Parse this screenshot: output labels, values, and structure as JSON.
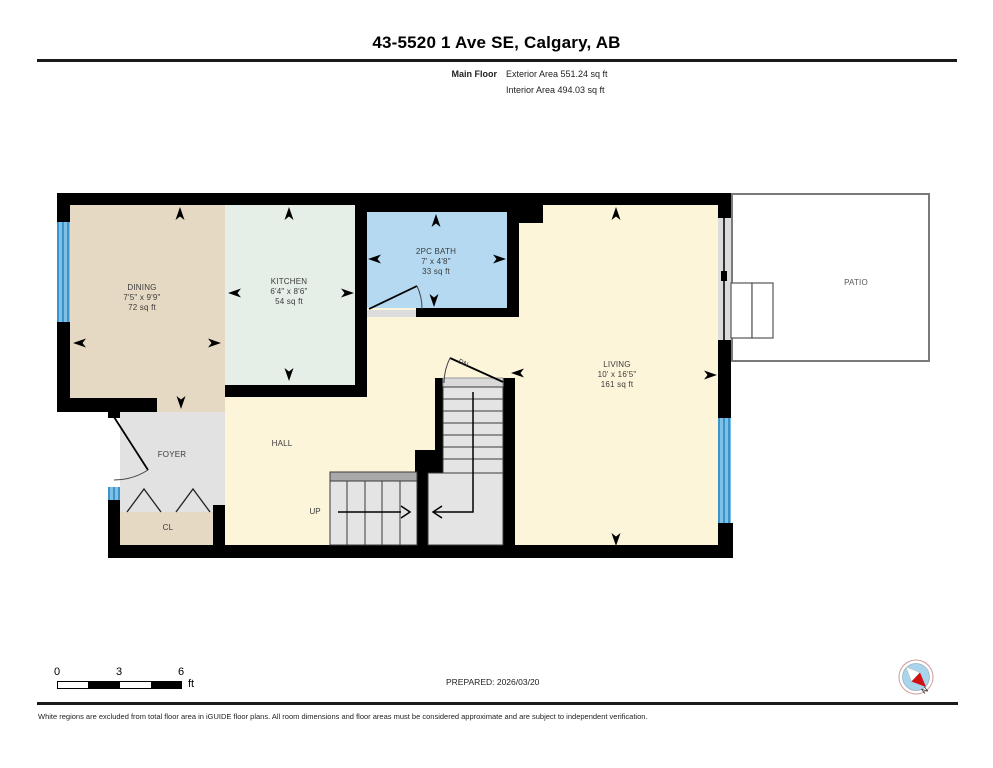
{
  "header": {
    "title": "43-5520 1 Ave SE, Calgary, AB",
    "floor_label": "Main Floor",
    "exterior_area": "Exterior Area 551.24 sq ft",
    "interior_area": "Interior Area 494.03 sq ft"
  },
  "rooms": {
    "dining": {
      "name": "DINING",
      "dims": "7'5\" x 9'9\"",
      "area": "72 sq ft"
    },
    "kitchen": {
      "name": "KITCHEN",
      "dims": "6'4\" x 8'6\"",
      "area": "54 sq ft"
    },
    "bath": {
      "name": "2PC BATH",
      "dims": "7' x 4'8\"",
      "area": "33 sq ft"
    },
    "living": {
      "name": "LIVING",
      "dims": "10' x 16'5\"",
      "area": "161 sq ft"
    },
    "patio": {
      "name": "PATIO"
    },
    "foyer": {
      "name": "FOYER"
    },
    "hall": {
      "name": "HALL"
    },
    "closet": {
      "name": "CL"
    }
  },
  "stairs": {
    "up": "UP",
    "down": "DN"
  },
  "scalebar": {
    "t0": "0",
    "t1": "3",
    "t2": "6",
    "unit": "ft"
  },
  "footer": {
    "prepared": "PREPARED: 2026/03/20",
    "disclaimer": "White regions are excluded from total floor area in iGUIDE floor plans. All room dimensions and floor areas must be considered approximate and are subject to independent verification.",
    "north": "N"
  },
  "colors": {
    "wall": "#000000",
    "dining": "#e6d9c3",
    "kitchen": "#e5efe8",
    "bath": "#b4d9f1",
    "living": "#fcf5da",
    "foyer": "#e2e2e2",
    "stairs": "#e4e4e4",
    "window": "#4aa3d8",
    "patio_border": "#7a7a7a",
    "compass_needle": "#d11111"
  }
}
